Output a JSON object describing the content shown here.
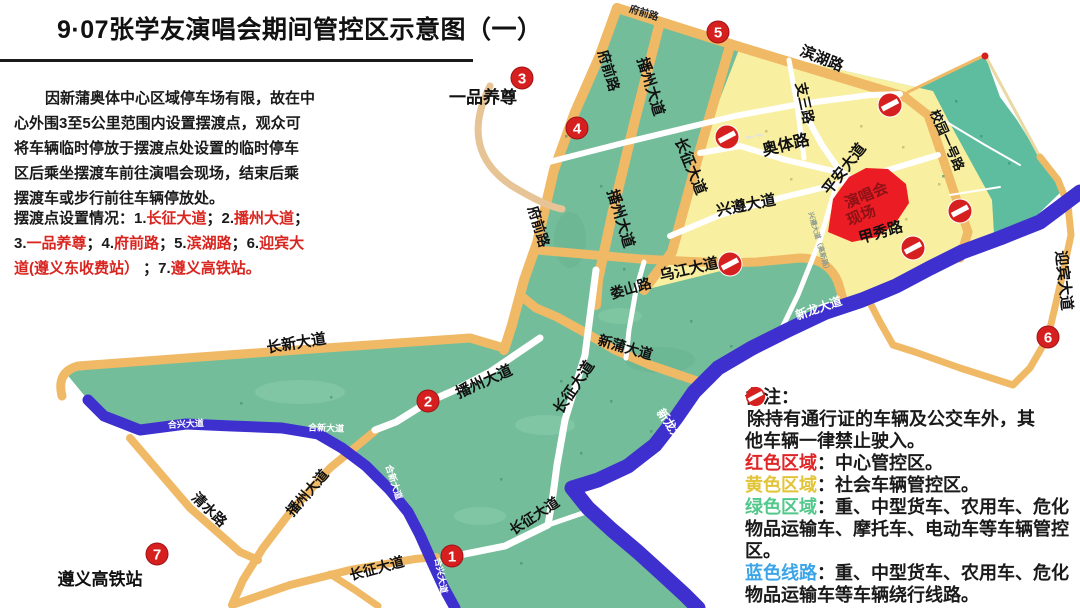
{
  "title": "9·07张学友演唱会期间管控区示意图（一）",
  "intro": {
    "lines": [
      "因新蒲奥体中心区域停车场有限，故在中",
      "心外围3至5公里范围内设置摆渡点，观众可",
      "将车辆临时停放于摆渡点处设置的临时停车",
      "区后乘坐摆渡车前往演唱会现场，结束后乘",
      "摆渡车或步行前往车辆停放处。"
    ]
  },
  "shuttle_note": {
    "black": "#1a1a1a",
    "red": "#d9251f",
    "lines": [
      [
        {
          "t": "摆渡点设置情况：1.",
          "c": "k"
        },
        {
          "t": "长征大道",
          "c": "r"
        },
        {
          "t": "；2.",
          "c": "k"
        },
        {
          "t": "播州大道",
          "c": "r"
        },
        {
          "t": "；",
          "c": "k"
        }
      ],
      [
        {
          "t": "3.",
          "c": "k"
        },
        {
          "t": "一品养尊",
          "c": "r"
        },
        {
          "t": "；4.",
          "c": "k"
        },
        {
          "t": "府前路",
          "c": "r"
        },
        {
          "t": "；5.",
          "c": "k"
        },
        {
          "t": "滨湖路",
          "c": "r"
        },
        {
          "t": "；6.",
          "c": "k"
        },
        {
          "t": "迎宾大",
          "c": "r"
        }
      ],
      [
        {
          "t": "道(遵义东收费站）",
          "c": "r"
        },
        {
          "t": " ；7.",
          "c": "k"
        },
        {
          "t": "遵义高铁站。",
          "c": "r"
        }
      ]
    ]
  },
  "legend": {
    "lines": [
      {
        "prefix": "",
        "pc": "",
        "text": "备注：",
        "icon": false
      },
      {
        "prefix": "",
        "pc": "",
        "text": "除持有通行证的车辆及公交车外，其",
        "icon": true
      },
      {
        "prefix": "",
        "pc": "",
        "text": "他车辆一律禁止驶入。",
        "icon": false
      },
      {
        "prefix": "红色区域",
        "pc": "#e02527",
        "text": "：中心管控区。",
        "icon": false
      },
      {
        "prefix": "黄色区域",
        "pc": "#e2c438",
        "text": "：社会车辆管控区。",
        "icon": false
      },
      {
        "prefix": "绿色区域",
        "pc": "#53c88b",
        "text": "：重、中型货车、农用车、危化",
        "icon": false
      },
      {
        "prefix": "",
        "pc": "",
        "text": "物品运输车、摩托车、电动车等车辆管控",
        "icon": false
      },
      {
        "prefix": "",
        "pc": "",
        "text": "区。",
        "icon": false
      },
      {
        "prefix": "蓝色线路",
        "pc": "#3ba5e8",
        "text": "：重、中型货车、农用车、危化",
        "icon": false
      },
      {
        "prefix": "",
        "pc": "",
        "text": "物品运输车等车辆绕行线路。",
        "icon": false
      }
    ]
  },
  "colors": {
    "green_zone": "#74bd9a",
    "teal_zone": "#5dbd9e",
    "yellow_zone": "#f8f0a0",
    "orange_road": "#f0b966",
    "blue_route": "#3e30cf",
    "red_marker": "#d6201f",
    "venue_red": "#ec1c24",
    "venue_text": "#8c1216"
  },
  "map": {
    "zones": [
      {
        "name": "green-landmass",
        "fill": "#74bd9a",
        "path": "M617,8 L740,47 L933,91 L948,120 L992,200 L994,234 L958,262 L930,276 L896,294 L862,308 L826,320 L788,338 L752,356 L718,376 L694,400 L676,426 L655,450 L628,470 L598,484 L572,490 L588,508 L612,530 L638,552 L660,572 L685,595 L692,608 L455,608 L444,588 L431,562 L420,535 L408,512 L390,490 L366,466 L342,448 L318,434 L282,428 L232,426 L186,424 L140,430 L102,416 L88,400 L65,372 L200,357 L340,347 L470,338 L504,348 L512,325 L524,280 L537,243 L554,170 L575,112 L600,55 Z"
      },
      {
        "name": "teal-zone",
        "fill": "#5dbd9e",
        "path": "M908,92 L985,55 L1000,97 L1017,120 L1040,157 L1065,188 L1030,222 L995,238 L960,253 L966,232 L953,195 L938,150 L925,118 Z"
      },
      {
        "name": "yellow-zone",
        "fill": "#f8f0a0",
        "path": "M740,47 L933,91 L948,120 L992,200 L994,234 L958,262 L930,276 L896,294 L862,306 L845,304 L838,282 L828,262 L800,258 L757,262 L644,290 L672,252 L700,150 Z"
      }
    ],
    "patches": [
      {
        "cx": 300,
        "cy": 392,
        "rx": 45,
        "ry": 12,
        "fill": "#8bcfae",
        "o": 0.5
      },
      {
        "cx": 545,
        "cy": 425,
        "rx": 30,
        "ry": 10,
        "fill": "#8bcfae",
        "o": 0.5
      },
      {
        "cx": 660,
        "cy": 360,
        "rx": 35,
        "ry": 13,
        "fill": "#63af8d",
        "o": 0.45
      },
      {
        "cx": 570,
        "cy": 240,
        "rx": 16,
        "ry": 28,
        "fill": "#63af8d",
        "o": 0.4
      },
      {
        "cx": 480,
        "cy": 516,
        "rx": 26,
        "ry": 9,
        "fill": "#8bcfae",
        "o": 0.5
      },
      {
        "cx": 620,
        "cy": 316,
        "rx": 22,
        "ry": 8,
        "fill": "#8bcfae",
        "o": 0.45
      }
    ],
    "roads": [
      {
        "name": "fuqianlu-top",
        "path": "M617,8 L740,47",
        "stroke": "#f0b966",
        "w": 10
      },
      {
        "name": "binhulu",
        "path": "M740,47 L905,97",
        "stroke": "#f0b966",
        "w": 10
      },
      {
        "name": "xiaoyuan-yihao-lu",
        "path": "M905,97 L928,115 L940,150 L955,195 L968,232 L960,258",
        "stroke": "#f0b966",
        "w": 9
      },
      {
        "name": "teal-edge-nw",
        "path": "M908,92 L985,55",
        "stroke": "#f0b966",
        "w": 3
      },
      {
        "name": "teal-edge-ne",
        "path": "M985,55 L1040,157",
        "stroke": "#ead9a4",
        "w": 3
      },
      {
        "name": "fuqianlu-west",
        "path": "M617,8 L600,55 L575,112 L554,170 L537,243 L524,280 L512,325 L504,350",
        "stroke": "#f0b966",
        "w": 10
      },
      {
        "name": "xinpu-dadao",
        "path": "M520,295 L536,308 L557,317 L586,333 L615,350 L650,365 L700,382",
        "stroke": "#f0b966",
        "w": 9
      },
      {
        "name": "changxin-dadao",
        "path": "M62,396 Q56,372 78,366 L200,357 L340,347 L470,338 L504,348",
        "stroke": "#f0b966",
        "w": 9
      },
      {
        "name": "bozhou-dadao-upper",
        "path": "M660,22 L635,120 L612,215 L598,280 L596,305",
        "stroke": "#f0b966",
        "w": 10
      },
      {
        "name": "changzheng-dadao-upper",
        "path": "M730,46 L700,150 L672,252 L644,290",
        "stroke": "#f0b966",
        "w": 10
      },
      {
        "name": "wujiang-dadao",
        "path": "M537,250 L640,259 L723,263 L757,262 L800,258 Q828,258 838,282 L845,306",
        "stroke": "#f0b966",
        "w": 9
      },
      {
        "name": "qingshuilu",
        "path": "M130,438 L190,508 L240,552 L258,560",
        "stroke": "#f0b966",
        "w": 8
      },
      {
        "name": "bozhou-dadao-lower",
        "path": "M375,431 L330,468 L292,510 L263,548 L243,580 L232,605",
        "stroke": "#f0b966",
        "w": 8
      },
      {
        "name": "changzheng-dadao-west",
        "path": "M235,604 L290,585 L350,570 L415,559 L436,557",
        "stroke": "#f0b966",
        "w": 8
      },
      {
        "name": "changzheng-spur-south",
        "path": "M330,574 L355,590 L378,606",
        "stroke": "#f0b966",
        "w": 7
      },
      {
        "name": "yingbin-dadao",
        "path": "M867,297 L880,322 L893,345 L915,352 L960,368 L1013,385 L1030,368 L1048,337 L1062,277 L1071,235 L1068,205 L1058,180 L1040,157",
        "stroke": "#f0b966",
        "w": 7
      },
      {
        "name": "yipin-connector",
        "path": "M490,86 Q458,150 512,186 Q545,206 562,209",
        "stroke": "#e7c496",
        "w": 7
      },
      {
        "name": "white-upper-cross",
        "path": "M510,172 L623,143 L735,116 L800,104 L870,95 L900,94",
        "stroke": "#fff",
        "w": 6
      },
      {
        "name": "aoti-lu",
        "path": "M700,153 L740,146 L786,160 L838,172",
        "stroke": "#fff",
        "w": 6
      },
      {
        "name": "zhisan-lu",
        "path": "M789,60 L797,105 L804,158",
        "stroke": "#fff",
        "w": 5
      },
      {
        "name": "pingan-dadao",
        "path": "M800,105 L822,145 L838,168 L849,178",
        "stroke": "#fff",
        "w": 6
      },
      {
        "name": "xingzun-dadao",
        "path": "M670,236 L720,215 L780,198 L838,184 L885,171 L938,155",
        "stroke": "#fff",
        "w": 6
      },
      {
        "name": "gaoxin-lu",
        "path": "M836,186 L820,240 L798,295 L780,332",
        "stroke": "#fff",
        "w": 5
      },
      {
        "name": "loushan-lu",
        "path": "M644,262 L636,290 L629,330 L626,358",
        "stroke": "#fff",
        "w": 5
      },
      {
        "name": "changzheng-central",
        "path": "M596,270 L585,355 L565,420 L557,465 L553,495 L548,525 L505,546 L455,556",
        "stroke": "#fff",
        "w": 7
      },
      {
        "name": "changzheng-central-spur",
        "path": "M548,525 L583,513",
        "stroke": "#fff",
        "w": 5
      },
      {
        "name": "bozhou-central",
        "path": "M540,338 L490,372 L455,390 L428,402 L396,422 L375,430",
        "stroke": "#fff",
        "w": 7
      },
      {
        "name": "teal-lane-1",
        "path": "M935,115 L985,145 L1020,165",
        "stroke": "#fff",
        "w": 2
      },
      {
        "name": "teal-lane-2",
        "path": "M950,195 L1000,187",
        "stroke": "#fff",
        "w": 2
      },
      {
        "name": "xinlong-dadao-river",
        "path": "M1080,192 L1040,222 L1000,238 L962,252 L930,268 L896,286 L862,300 L826,312 L788,330 L752,348 L718,368 L694,392 L676,418 L655,445 L628,466 L598,480 L572,488 L588,508 L612,530 L638,552 L660,572 L685,595 L698,608",
        "stroke": "#3e30cf",
        "w": 15
      },
      {
        "name": "hexin-hexing-loop",
        "path": "M88,400 L104,416 L140,430 L186,424 L232,426 L282,428 L318,434 L342,448 L366,466 L390,490 L408,512 L420,535 L432,562 L444,588 L455,608",
        "stroke": "#3e30cf",
        "w": 11
      }
    ],
    "venue": {
      "path": "M828,232 L833,199 L849,177 L866,168 L888,169 L906,184 L909,203 L895,224 L877,237 L852,242 Z",
      "fill": "#ec1c24",
      "label_color": "#8c1216",
      "labels": [
        {
          "t": "演唱会",
          "x": 868,
          "y": 200
        },
        {
          "t": "现场",
          "x": 863,
          "y": 220
        }
      ],
      "rot": -22
    },
    "labels": [
      {
        "t": "府前路",
        "x": 643,
        "y": 16,
        "r": 17,
        "s": 10,
        "c": "#222"
      },
      {
        "t": "滨湖路",
        "x": 820,
        "y": 63,
        "r": 22,
        "s": 15,
        "c": "#111"
      },
      {
        "t": "支三路",
        "x": 800,
        "y": 104,
        "r": 78,
        "s": 14,
        "c": "#111"
      },
      {
        "t": "校园一号路",
        "x": 943,
        "y": 142,
        "r": 66,
        "s": 13,
        "c": "#111"
      },
      {
        "t": "奥体路",
        "x": 787,
        "y": 150,
        "r": -14,
        "s": 16,
        "c": "#111"
      },
      {
        "t": "平安大道",
        "x": 848,
        "y": 172,
        "r": -52,
        "s": 15,
        "c": "#111"
      },
      {
        "t": "兴遵大道",
        "x": 747,
        "y": 210,
        "r": -11,
        "s": 15,
        "c": "#111"
      },
      {
        "t": "甲秀路",
        "x": 882,
        "y": 237,
        "r": -16,
        "s": 15,
        "c": "#111"
      },
      {
        "t": "乌江大道",
        "x": 690,
        "y": 274,
        "r": -13,
        "s": 15,
        "c": "#111"
      },
      {
        "t": "娄山路",
        "x": 632,
        "y": 293,
        "r": -16,
        "s": 14,
        "c": "#111"
      },
      {
        "t": "新蒲大道",
        "x": 624,
        "y": 352,
        "r": 16,
        "s": 14,
        "c": "#111"
      },
      {
        "t": "长征大道",
        "x": 578,
        "y": 390,
        "r": -56,
        "s": 15,
        "c": "#111"
      },
      {
        "t": "播州大道",
        "x": 486,
        "y": 386,
        "r": -24,
        "s": 15,
        "c": "#111"
      },
      {
        "t": "长新大道",
        "x": 297,
        "y": 348,
        "r": -9,
        "s": 15,
        "c": "#111"
      },
      {
        "t": "清水路",
        "x": 206,
        "y": 513,
        "r": 44,
        "s": 14,
        "c": "#111"
      },
      {
        "t": "播州大道",
        "x": 311,
        "y": 496,
        "r": -49,
        "s": 14,
        "c": "#111"
      },
      {
        "t": "长征大道",
        "x": 378,
        "y": 573,
        "r": -15,
        "s": 14,
        "c": "#111"
      },
      {
        "t": "长征大道",
        "x": 537,
        "y": 520,
        "r": -33,
        "s": 14,
        "c": "#111"
      },
      {
        "t": "长征大道",
        "x": 686,
        "y": 168,
        "r": 68,
        "s": 15,
        "c": "#111"
      },
      {
        "t": "播州大道",
        "x": 646,
        "y": 88,
        "r": 73,
        "s": 15,
        "c": "#111"
      },
      {
        "t": "播州大道",
        "x": 616,
        "y": 220,
        "r": 73,
        "s": 15,
        "c": "#111"
      },
      {
        "t": "府前路",
        "x": 604,
        "y": 72,
        "r": 73,
        "s": 14,
        "c": "#111"
      },
      {
        "t": "府前路",
        "x": 534,
        "y": 228,
        "r": 73,
        "s": 14,
        "c": "#111"
      },
      {
        "t": "迎宾大道",
        "x": 1059,
        "y": 281,
        "r": 84,
        "s": 15,
        "c": "#111"
      },
      {
        "t": "新龙大道",
        "x": 820,
        "y": 312,
        "r": -19,
        "s": 12,
        "c": "#fff"
      },
      {
        "t": "新龙大道",
        "x": 670,
        "y": 432,
        "r": 55,
        "s": 12,
        "c": "#fff"
      },
      {
        "t": "合兴大道",
        "x": 186,
        "y": 427,
        "r": -3,
        "s": 9,
        "c": "#fff"
      },
      {
        "t": "合新大道",
        "x": 326,
        "y": 431,
        "r": 2,
        "s": 9,
        "c": "#fff"
      },
      {
        "t": "合新大道",
        "x": 391,
        "y": 483,
        "r": 72,
        "s": 9,
        "c": "#fff"
      },
      {
        "t": "合兴大道",
        "x": 438,
        "y": 576,
        "r": 80,
        "s": 9,
        "c": "#fff"
      },
      {
        "t": "兴遵大道（高新路）",
        "x": 817,
        "y": 243,
        "r": 74,
        "s": 7,
        "c": "#8d9a90"
      },
      {
        "t": "一品养尊",
        "x": 483,
        "y": 103,
        "r": 0,
        "s": 17,
        "c": "#111"
      },
      {
        "t": "遵义高铁站",
        "x": 100,
        "y": 585,
        "r": 0,
        "s": 17,
        "c": "#111"
      }
    ],
    "shuttle_points": [
      {
        "n": "1",
        "x": 452,
        "y": 556
      },
      {
        "n": "2",
        "x": 428,
        "y": 401
      },
      {
        "n": "3",
        "x": 522,
        "y": 78
      },
      {
        "n": "4",
        "x": 577,
        "y": 128
      },
      {
        "n": "5",
        "x": 718,
        "y": 32
      },
      {
        "n": "6",
        "x": 1048,
        "y": 337
      },
      {
        "n": "7",
        "x": 157,
        "y": 554
      }
    ],
    "no_entry_signs": [
      {
        "x": 890,
        "y": 105
      },
      {
        "x": 727,
        "y": 137
      },
      {
        "x": 960,
        "y": 211
      },
      {
        "x": 913,
        "y": 248
      },
      {
        "x": 730,
        "y": 264
      }
    ],
    "dashes": [
      {
        "x": 746,
        "y": 136
      },
      {
        "x": 756,
        "y": 134
      }
    ],
    "red_dot": {
      "x": 985,
      "y": 56
    },
    "specks": [
      {
        "x": 765,
        "y": 130,
        "c": "#b1a95c"
      },
      {
        "x": 860,
        "y": 125,
        "c": "#b1a95c"
      },
      {
        "x": 902,
        "y": 146,
        "c": "#b1a95c"
      },
      {
        "x": 790,
        "y": 178,
        "c": "#b1a95c"
      },
      {
        "x": 905,
        "y": 218,
        "c": "#b1a95c"
      },
      {
        "x": 938,
        "y": 183,
        "c": "#b1a95c"
      },
      {
        "x": 565,
        "y": 135,
        "c": "#3f8a6d"
      },
      {
        "x": 600,
        "y": 185,
        "c": "#3f8a6d"
      },
      {
        "x": 623,
        "y": 268,
        "c": "#3f8a6d"
      },
      {
        "x": 955,
        "y": 100,
        "c": "#2f8a70"
      },
      {
        "x": 980,
        "y": 135,
        "c": "#2f8a70"
      },
      {
        "x": 1008,
        "y": 162,
        "c": "#2f8a70"
      },
      {
        "x": 942,
        "y": 175,
        "c": "#2f8a70"
      },
      {
        "x": 690,
        "y": 320,
        "c": "#3f8a6d"
      },
      {
        "x": 730,
        "y": 345,
        "c": "#3f8a6d"
      },
      {
        "x": 560,
        "y": 380,
        "c": "#3f8a6d"
      },
      {
        "x": 610,
        "y": 400,
        "c": "#3f8a6d"
      },
      {
        "x": 650,
        "y": 430,
        "c": "#3f8a6d"
      },
      {
        "x": 580,
        "y": 452,
        "c": "#3f8a6d"
      },
      {
        "x": 500,
        "y": 478,
        "c": "#3f8a6d"
      },
      {
        "x": 330,
        "y": 396,
        "c": "#3f8a6d"
      },
      {
        "x": 240,
        "y": 402,
        "c": "#3f8a6d"
      },
      {
        "x": 520,
        "y": 562,
        "c": "#3f8a6d"
      }
    ]
  }
}
